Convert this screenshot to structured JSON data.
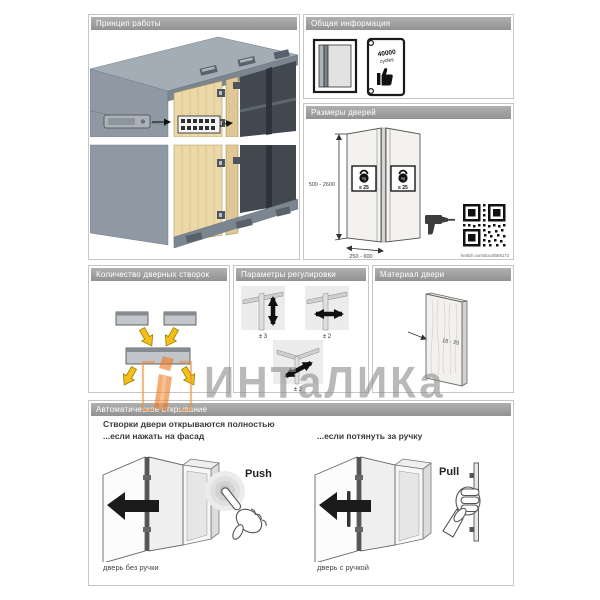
{
  "panels": {
    "principle": {
      "title": "Принцип работы"
    },
    "general": {
      "title": "Общая информация",
      "cycles_value": "40000",
      "cycles_unit": "cycles"
    },
    "sizes": {
      "title": "Размеры дверей",
      "height_range": "500 - 2600",
      "width_range": "250 - 600",
      "weight_limit": "≤ 25",
      "weight_unit": "kg",
      "doc_link": "hettich.com/docs/B66172"
    },
    "leaves": {
      "title": "Количество дверных створок"
    },
    "adjust": {
      "title": "Параметры регулировки",
      "vertical": "± 3",
      "horizontal": "± 2",
      "depth": "± 2"
    },
    "material": {
      "title": "Материал двери",
      "thickness": "16 - 25"
    },
    "auto": {
      "title": "Автоматическое открывание",
      "intro_line1": "Створки двери открываются полностью",
      "intro_line2": "...если нажать на фасад",
      "intro_right": "...если потянуть за ручку",
      "push_label": "Push",
      "pull_label": "Pull",
      "caption_no_handle": "дверь без ручки",
      "caption_handle": "дверь с ручкой"
    }
  },
  "watermark": {
    "text": "ИНТаЛИКа"
  },
  "colors": {
    "accent_orange": "#ee7a22",
    "wood": "#ecd9a9",
    "carcass_gray": "#8f99a4",
    "arrow_yellow": "#f2c118"
  }
}
